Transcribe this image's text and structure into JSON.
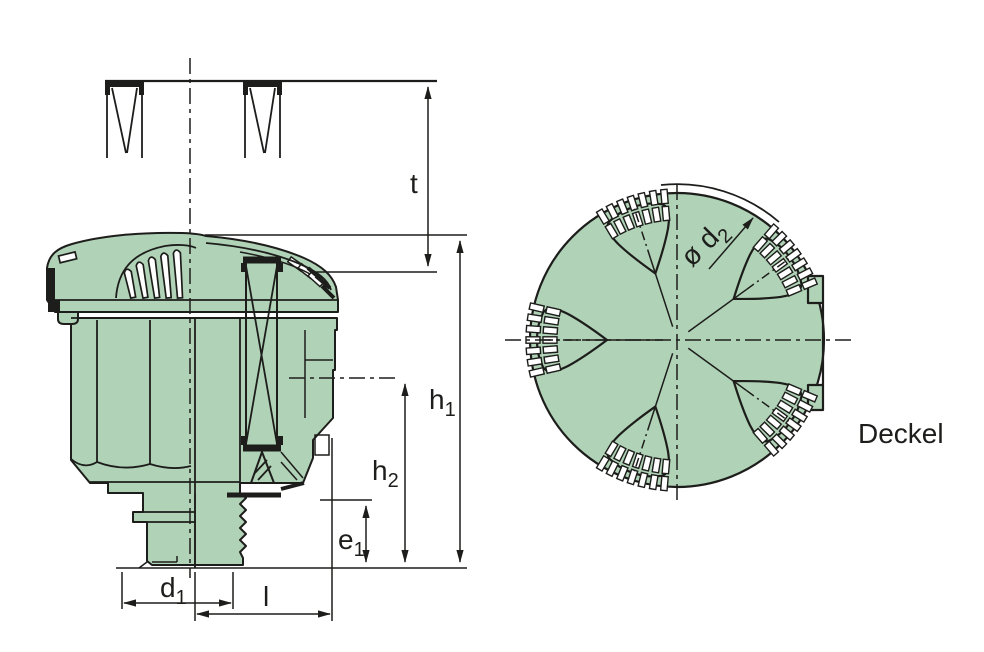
{
  "labels": {
    "t": {
      "base": "t",
      "sub": ""
    },
    "h1": {
      "base": "h",
      "sub": "1"
    },
    "h2": {
      "base": "h",
      "sub": "2"
    },
    "e1": {
      "base": "e",
      "sub": "1"
    },
    "d1": {
      "base": "d",
      "sub": "1"
    },
    "l": {
      "base": "l",
      "sub": ""
    },
    "d2": {
      "base": "ø d",
      "sub": "2"
    },
    "cover": "Deckel"
  },
  "colors": {
    "part_fill": "#b0d2b6",
    "slot_fill": "#ffffff",
    "line": "#1d1d1b",
    "background": "#ffffff"
  }
}
